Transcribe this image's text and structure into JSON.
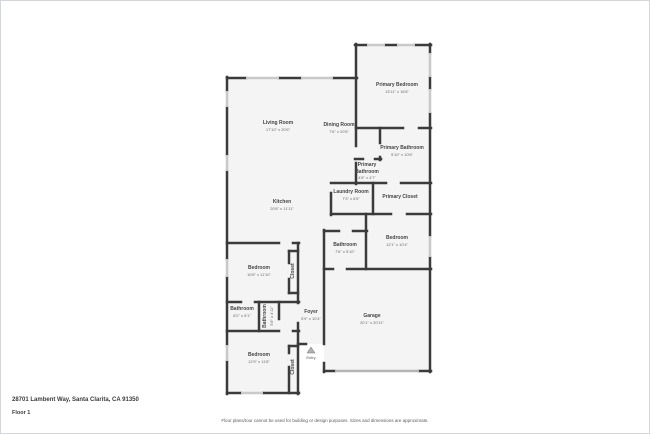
{
  "page": {
    "address": "28701 Lambent Way, Santa Clarita, CA 91350",
    "floor_label": "Floor 1",
    "disclaimer": "Floor plans/tour cannot be used for building or design purposes. Sizes and dimensions are approximate."
  },
  "colors": {
    "wall": "#3b3b3b",
    "window": "#c9c9c9",
    "garage_door": "#b5b5b5",
    "room_fill": "#f4f4f4",
    "label_text": "#4a4a4a"
  },
  "rooms": {
    "living_room": {
      "name": "Living Room",
      "dims": "17'10\" x 20'6\""
    },
    "dining_room": {
      "name": "Dining Room",
      "dims": "7'6\" x 20'6\""
    },
    "kitchen": {
      "name": "Kitchen",
      "dims": "20'6\" x 11'11\""
    },
    "primary_bedroom": {
      "name": "Primary Bedroom",
      "dims": "13'11\" x 16'8\""
    },
    "primary_bathroom": {
      "name": "Primary Bathroom",
      "dims": "9'10\" x 10'6\""
    },
    "primary_bathroom_2": {
      "name": "Primary Bathroom",
      "dims": "4'8\" x 4'7\""
    },
    "laundry_room": {
      "name": "Laundry Room",
      "dims": "7'3\" x 6'5\""
    },
    "primary_closet": {
      "name": "Primary Closet",
      "dims": ""
    },
    "bathroom_2": {
      "name": "Bathroom",
      "dims": "7'6\" x 5'10\""
    },
    "bedroom_2": {
      "name": "Bedroom",
      "dims": "12'1\" x 10'4\""
    },
    "bedroom_3": {
      "name": "Bedroom",
      "dims": "10'8\" x 11'10\""
    },
    "closet_1": {
      "name": "Closet",
      "dims": ""
    },
    "bathroom_3": {
      "name": "Bathroom",
      "dims": "8'2\" x 5'1\""
    },
    "bathroom_4": {
      "name": "Bathroom",
      "dims": "5'8\" x 4'11\""
    },
    "foyer": {
      "name": "Foyer",
      "dims": "5'9\" x 10'4\""
    },
    "bedroom_4": {
      "name": "Bedroom",
      "dims": "12'9\" x 11'8\""
    },
    "closet_2": {
      "name": "Closet",
      "dims": ""
    },
    "garage": {
      "name": "Garage",
      "dims": "20'1\" x 20'11\""
    },
    "entry": {
      "name": "Entry",
      "dims": ""
    }
  }
}
